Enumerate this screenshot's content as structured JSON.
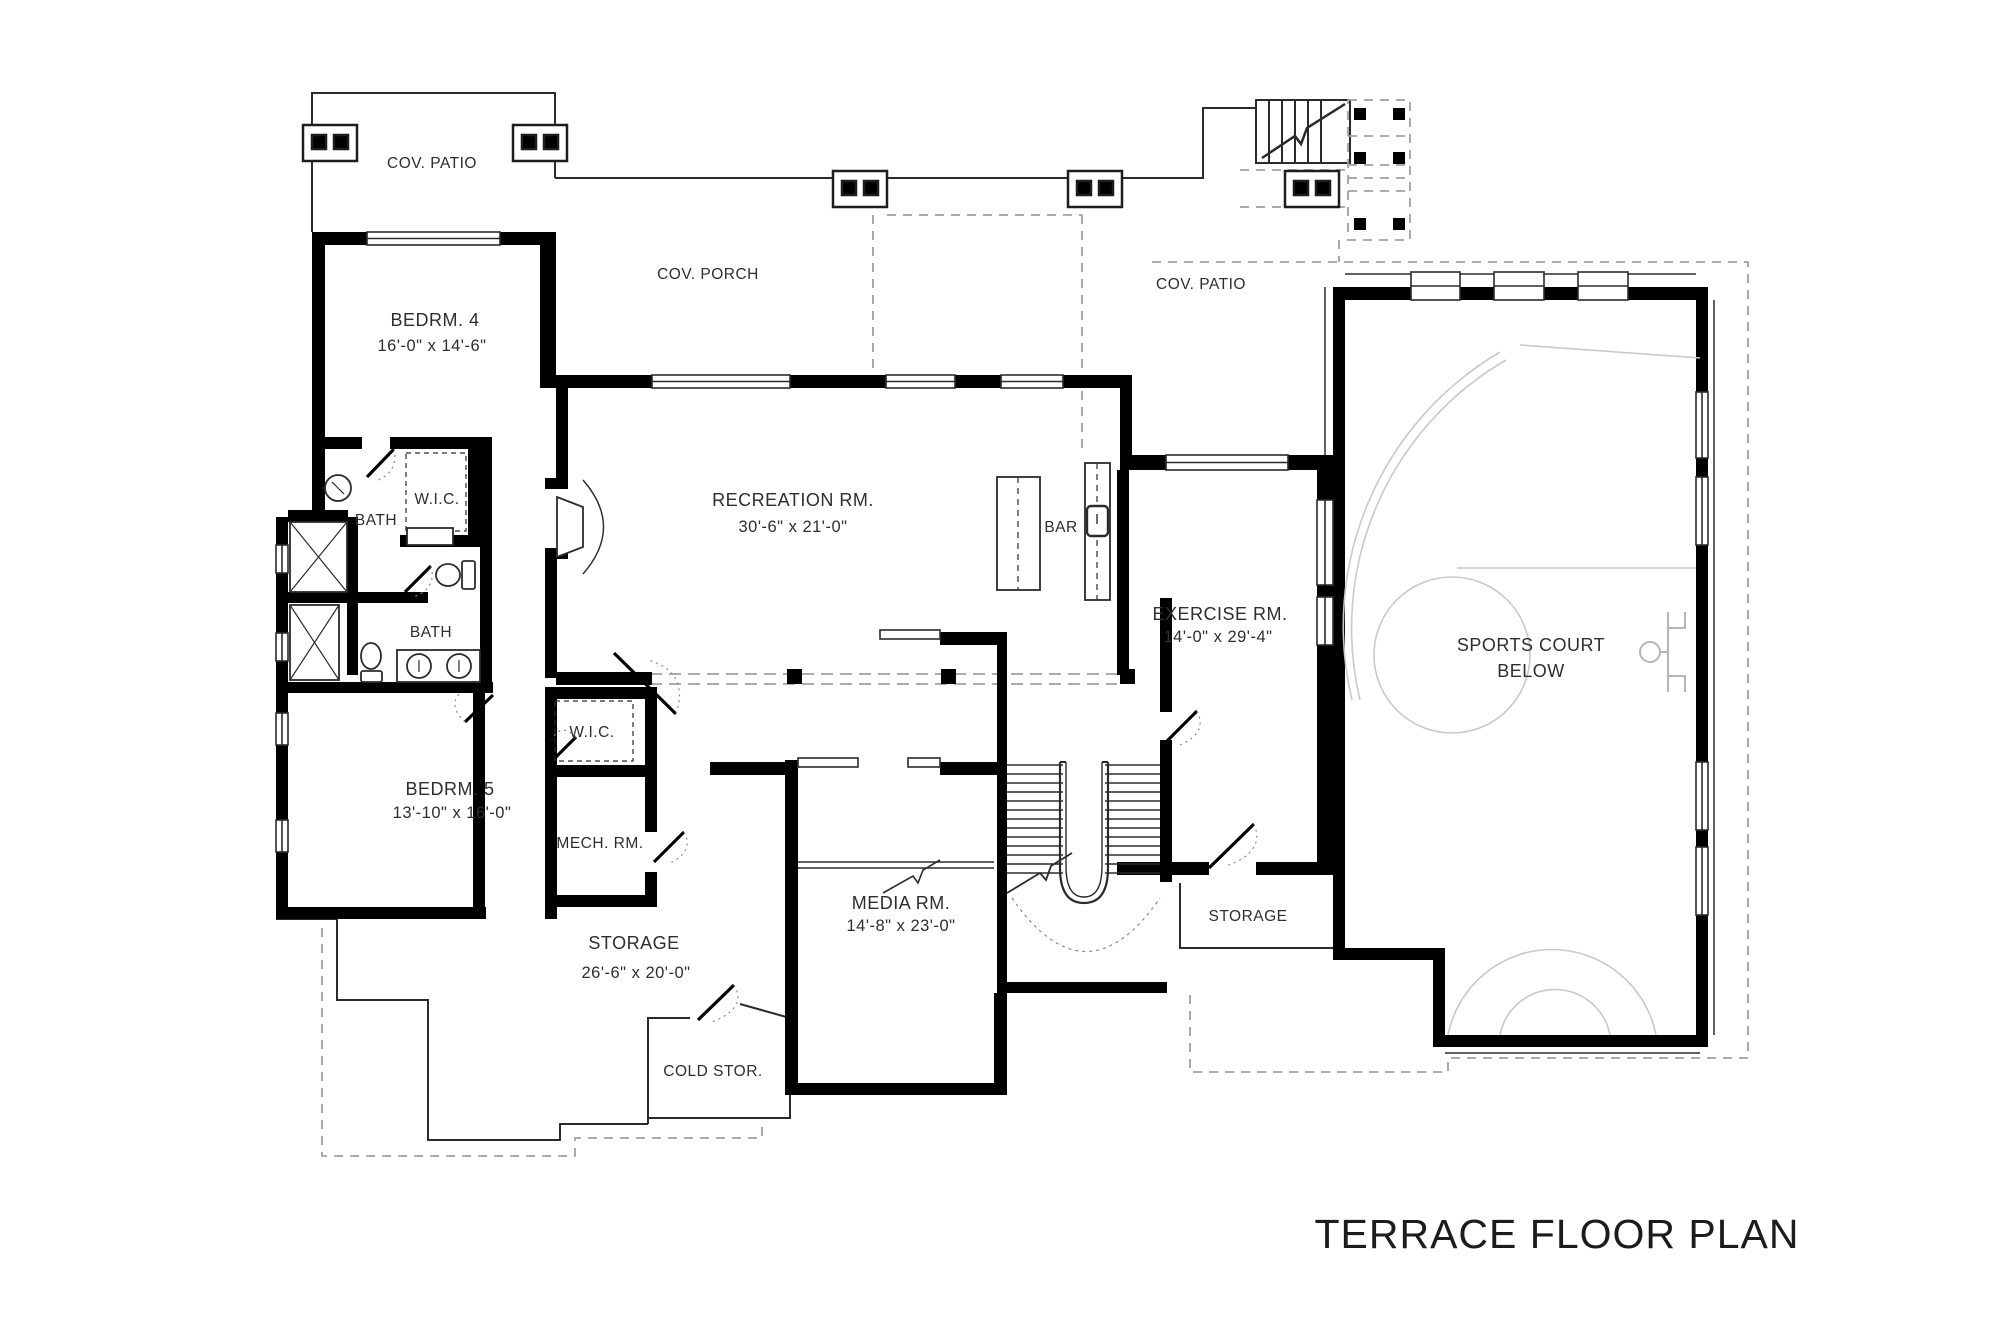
{
  "title": "TERRACE FLOOR PLAN",
  "rooms": {
    "cov_patio_left": {
      "name": "COV. PATIO"
    },
    "cov_porch": {
      "name": "COV. PORCH"
    },
    "cov_patio_right": {
      "name": "COV. PATIO"
    },
    "bedrm4": {
      "name": "BEDRM. 4",
      "dims": "16'-0\" x 14'-6\""
    },
    "bath1": {
      "name": "BATH"
    },
    "wic1": {
      "name": "W.I.C."
    },
    "bath2": {
      "name": "BATH"
    },
    "bedrm5": {
      "name": "BEDRM. 5",
      "dims": "13'-10\" x 16'-0\""
    },
    "wic2": {
      "name": "W.I.C."
    },
    "mech": {
      "name": "MECH. RM."
    },
    "recreation": {
      "name": "RECREATION RM.",
      "dims": "30'-6\" x 21'-0\""
    },
    "bar": {
      "name": "BAR"
    },
    "exercise": {
      "name": "EXERCISE RM.",
      "dims": "14'-0\" x 29'-4\""
    },
    "sports_court": {
      "line1": "SPORTS COURT",
      "line2": "BELOW"
    },
    "media": {
      "name": "MEDIA RM.",
      "dims": "14'-8\" x 23'-0\""
    },
    "storage_stairs": {
      "name": "STORAGE"
    },
    "storage_main": {
      "name": "STORAGE",
      "dims": "26'-6\" x 20'-0\""
    },
    "cold_storage": {
      "name": "COLD STOR."
    }
  },
  "colors": {
    "wall": "#000000",
    "thin_line": "#2b2b2b",
    "dashed": "#a0a0a0",
    "court": "#c9c9c9"
  }
}
